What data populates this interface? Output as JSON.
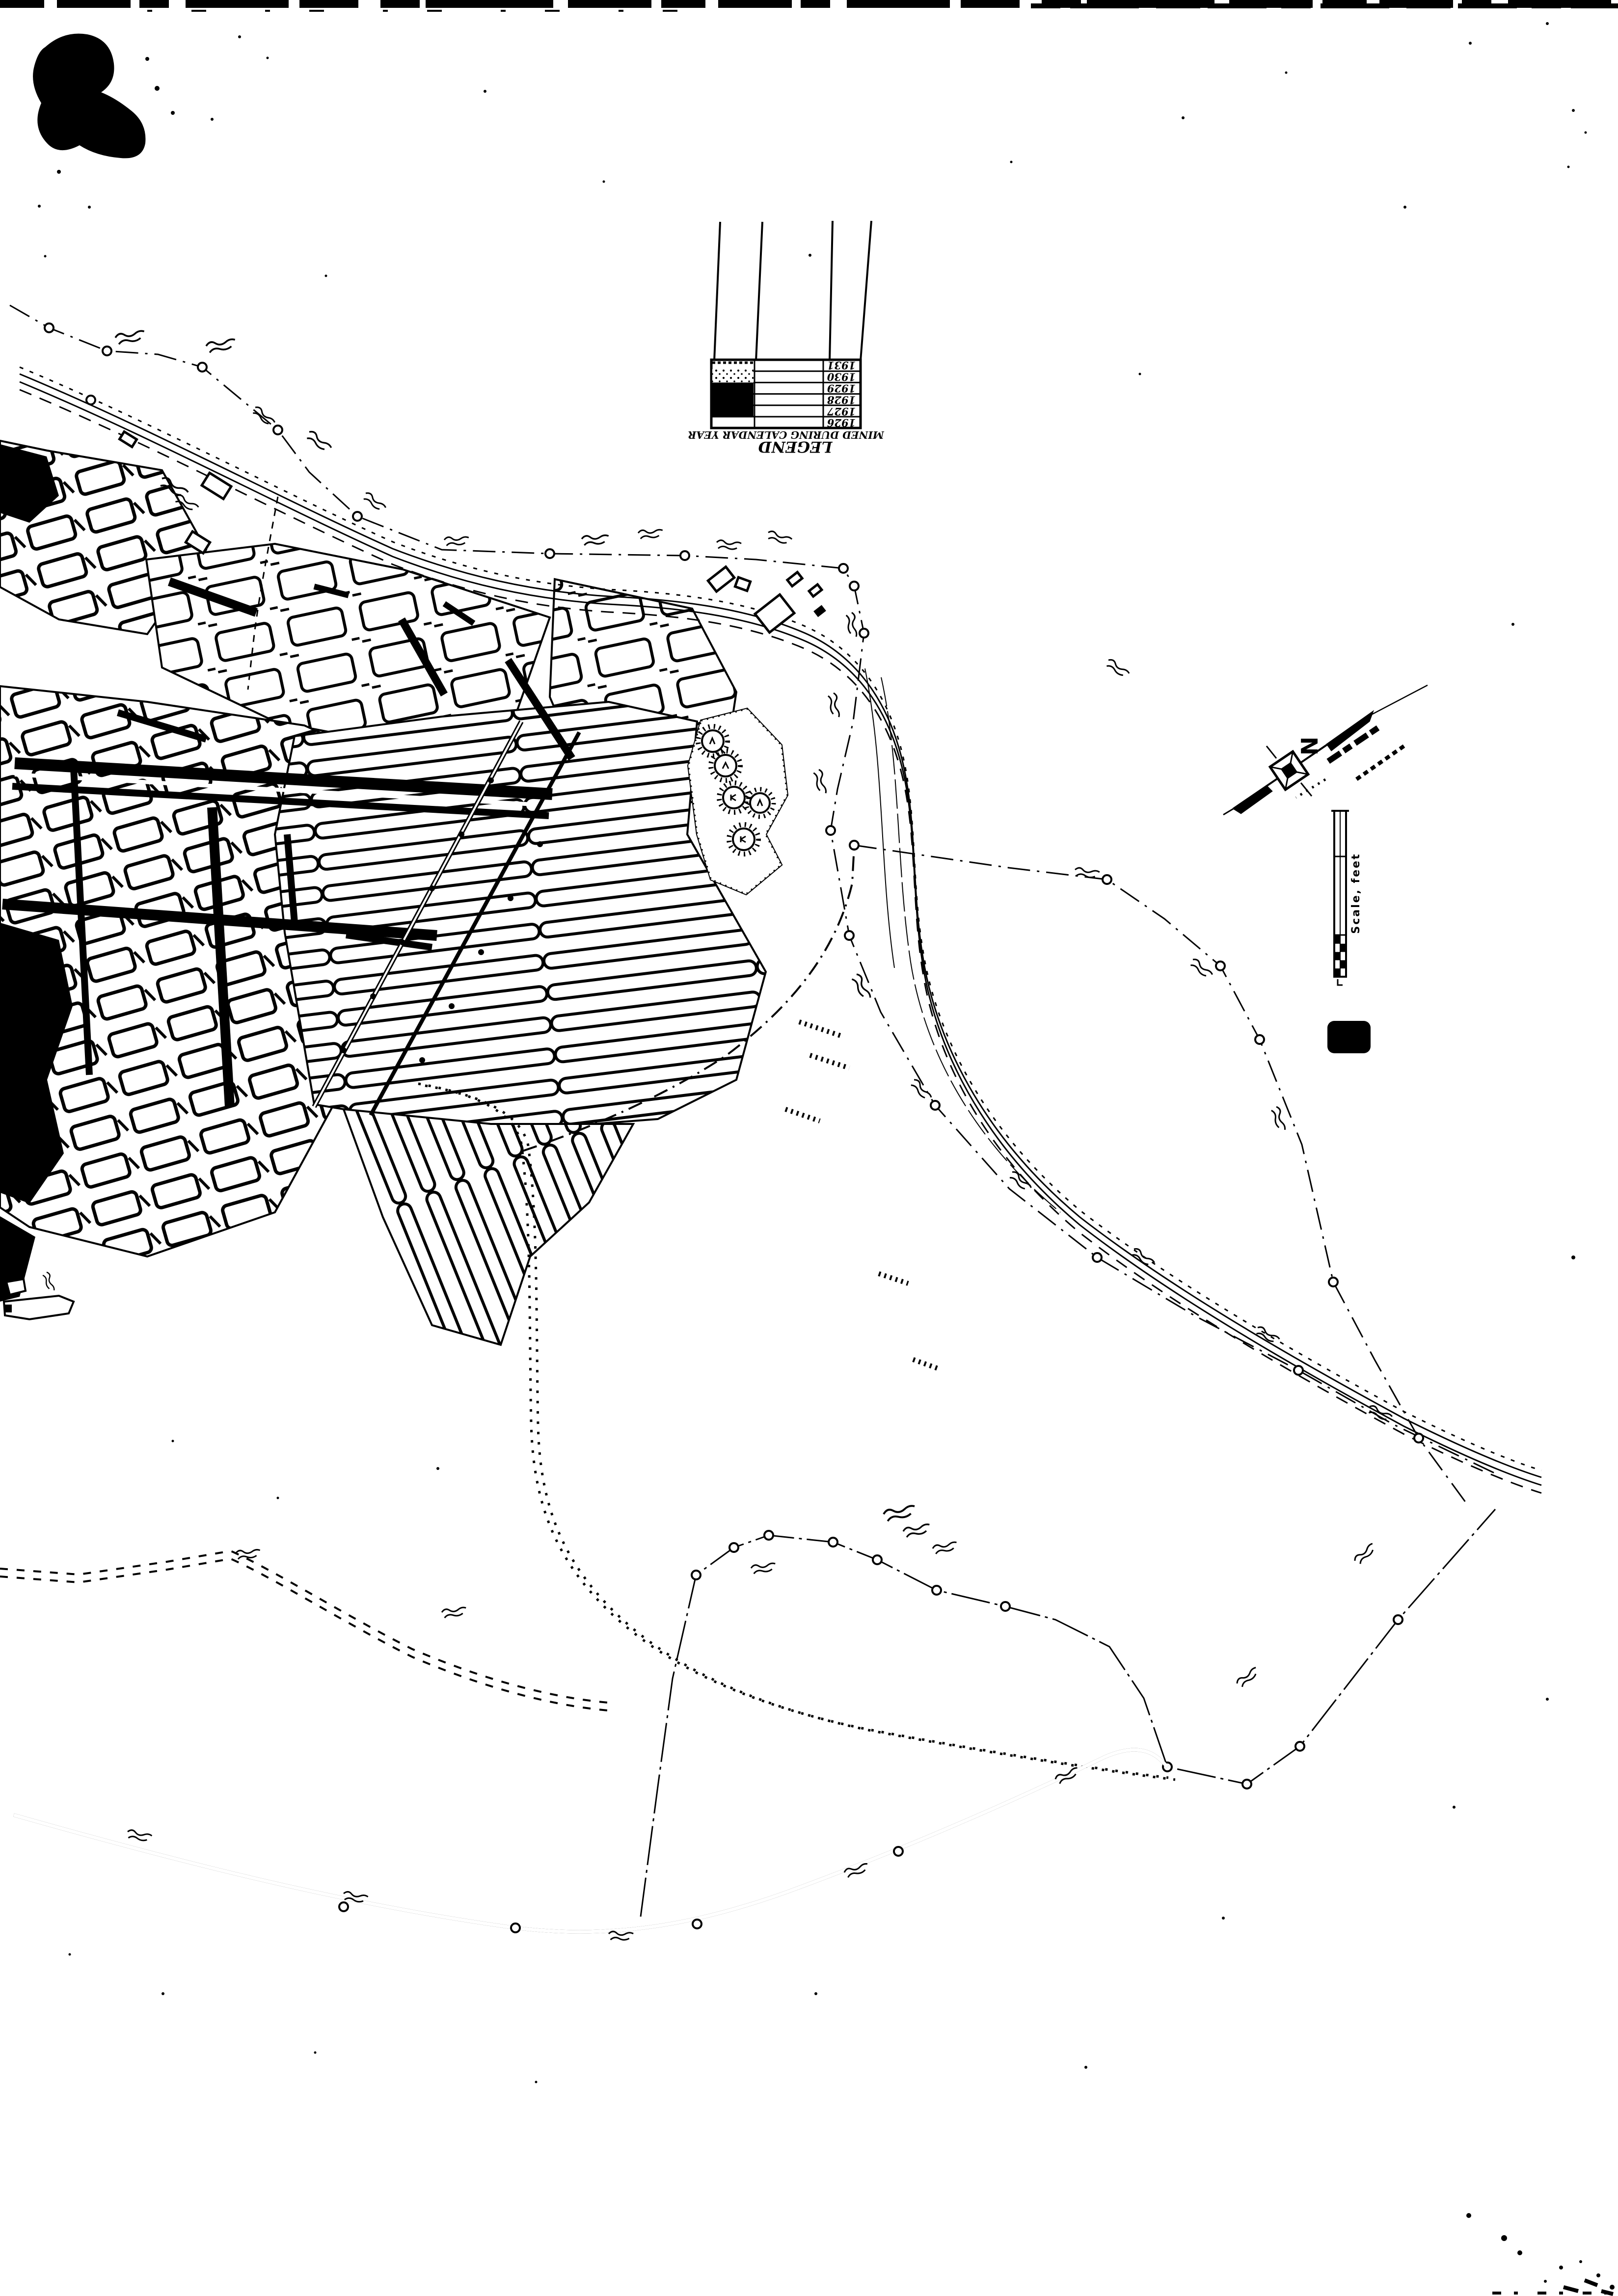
{
  "page": {
    "kind": "scanned mine-workings and shoreline map sheet",
    "colors": {
      "paper": "#ffffff",
      "ink": "#000000"
    }
  },
  "legend": {
    "title": "LEGEND",
    "subtitle": "MINED DURING CALENDAR YEAR",
    "orientation": "rotated-180",
    "rows": [
      {
        "year": "1931",
        "swatch": "blank-speckled-edge"
      },
      {
        "year": "1930",
        "swatch": "stipple"
      },
      {
        "year": "1929",
        "swatch": "solid"
      },
      {
        "year": "1928",
        "swatch": "solid"
      },
      {
        "year": "1927",
        "swatch": "solid"
      },
      {
        "year": "1926",
        "swatch": "blank"
      }
    ]
  },
  "north_arrow": {
    "label": "N"
  },
  "scale_bar": {
    "label": "Scale, feet"
  },
  "sheet_number": "2"
}
